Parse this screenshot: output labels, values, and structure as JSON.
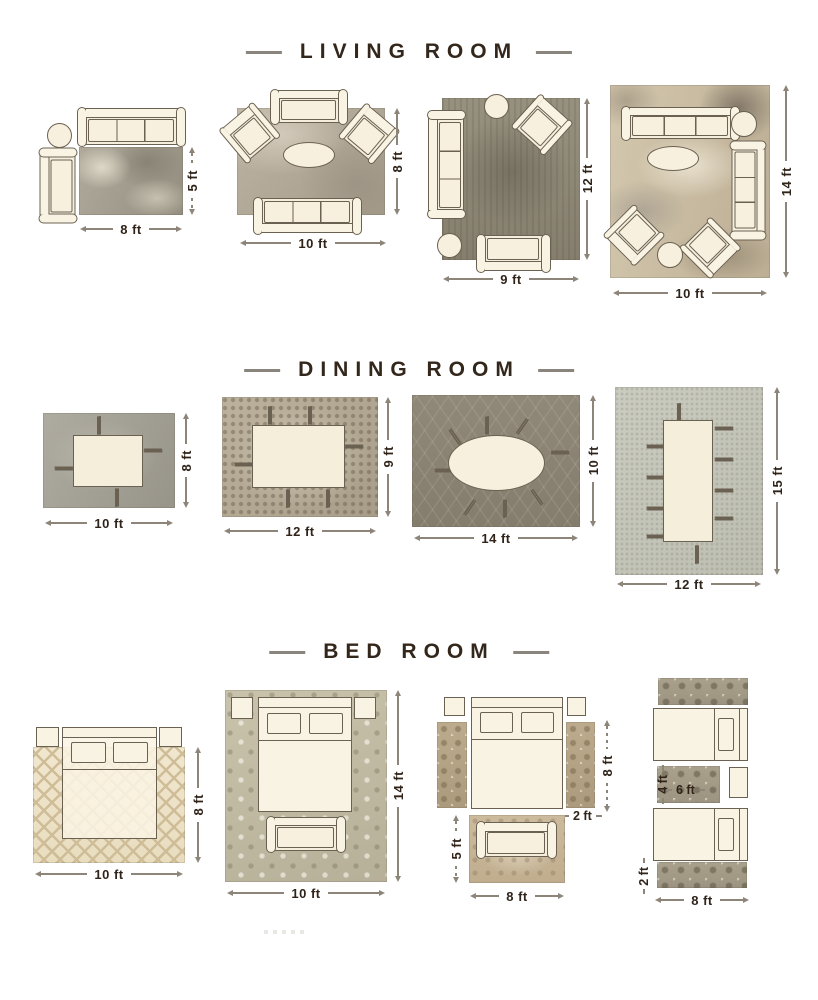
{
  "colors": {
    "background": "#ffffff",
    "ink": "#33261a",
    "dimension_line": "#8d8579",
    "furniture_fill": "#f9f3e3",
    "furniture_outline": "#6b6152"
  },
  "sections": [
    {
      "id": "living-room",
      "title": "LIVING ROOM",
      "layouts": [
        {
          "labels": {
            "width": "8 ft",
            "height": "5 ft"
          }
        },
        {
          "labels": {
            "width": "10 ft",
            "height": "8 ft"
          }
        },
        {
          "labels": {
            "width": "9 ft",
            "height": "12 ft"
          }
        },
        {
          "labels": {
            "width": "10 ft",
            "height": "14 ft"
          }
        }
      ]
    },
    {
      "id": "dining-room",
      "title": "DINING ROOM",
      "layouts": [
        {
          "labels": {
            "width": "10 ft",
            "height": "8 ft"
          }
        },
        {
          "labels": {
            "width": "12 ft",
            "height": "9 ft"
          }
        },
        {
          "labels": {
            "width": "14 ft",
            "height": "10 ft"
          }
        },
        {
          "labels": {
            "width": "12 ft",
            "height": "15 ft"
          }
        }
      ]
    },
    {
      "id": "bed-room",
      "title": "BED ROOM",
      "layouts": [
        {
          "labels": {
            "width": "10 ft",
            "height": "8 ft"
          }
        },
        {
          "labels": {
            "width": "10 ft",
            "height": "14 ft"
          }
        },
        {
          "labels": {
            "bed_height": "8 ft",
            "runner_width": "2 ft",
            "bench_rug_height": "5 ft",
            "bench_rug_width": "8 ft"
          }
        },
        {
          "labels": {
            "accent_rug_height": "4 ft",
            "accent_rug_width": "6 ft",
            "runner_height": "2 ft",
            "runner_width": "8 ft"
          }
        }
      ]
    }
  ]
}
